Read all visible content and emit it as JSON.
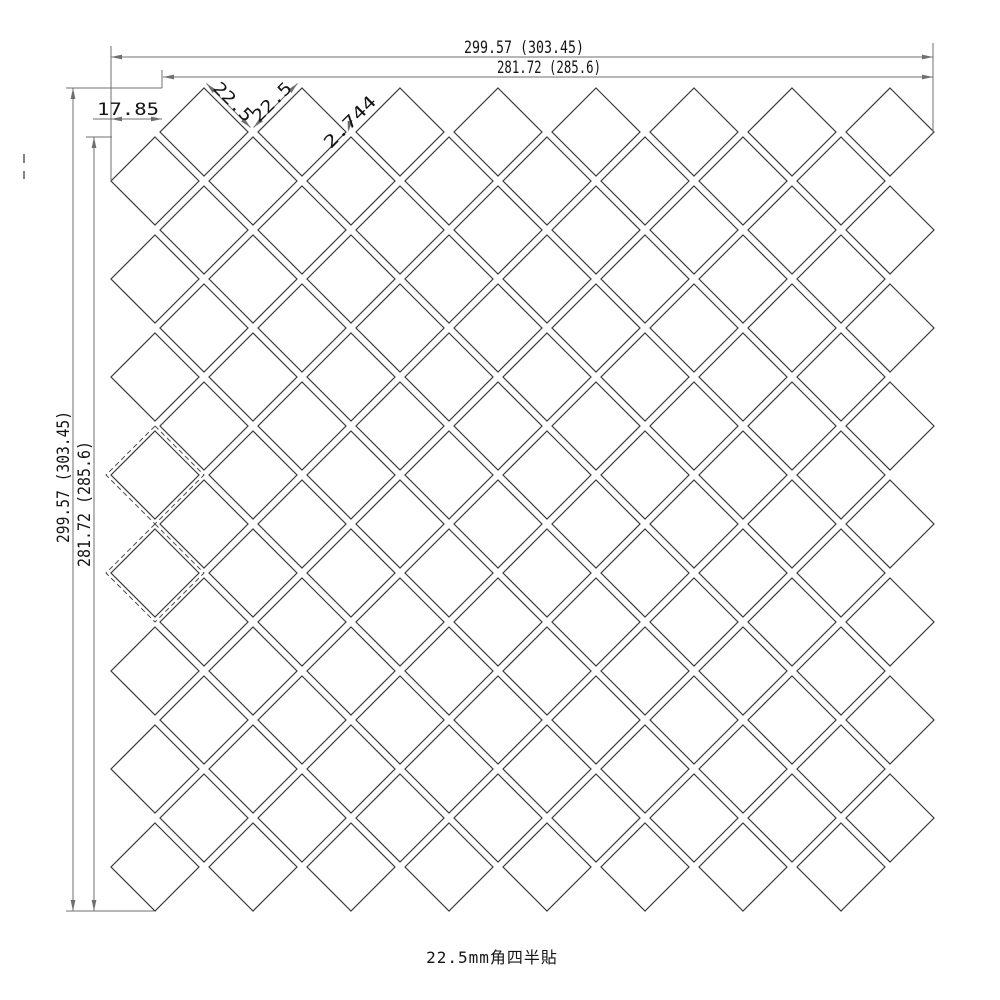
{
  "drawing": {
    "caption": "22.5mm角四半貼",
    "colors": {
      "background": "#ffffff",
      "tile_line": "#3a3a3a",
      "dash_line": "#4a4a4a",
      "dim_line": "#6f6f6f",
      "dim_text": "#141414"
    },
    "pattern": {
      "tile_size_mm": "22.5",
      "joint_mm": "2.744",
      "tile_half_diag_px": 44,
      "dash_half_diag_px": 49,
      "pitch_px": 98,
      "grid_a": {
        "x0": 204,
        "y0": 132,
        "cols": 8,
        "rows": 8
      },
      "grid_b": {
        "x0": 155,
        "y0": 181,
        "cols": 8,
        "rows": 8
      },
      "dashed_cells": [
        {
          "cx": 155,
          "cy": 475,
          "r": 49
        },
        {
          "cx": 155,
          "cy": 573,
          "r": 49
        }
      ]
    },
    "extension_lines": [
      [
        111,
        46,
        111,
        181
      ],
      [
        933,
        43,
        933,
        132
      ],
      [
        162,
        70,
        162,
        88
      ],
      [
        66,
        88,
        162,
        88
      ],
      [
        86,
        137,
        112,
        137
      ],
      [
        66,
        911,
        154,
        911
      ]
    ],
    "stray_marks": [
      [
        24,
        154,
        24,
        163
      ],
      [
        24,
        171,
        24,
        179
      ]
    ],
    "dims": [
      {
        "name": "dim-top-outer",
        "label": "299.57 (303.45)",
        "line": [
          111,
          57,
          933,
          57
        ],
        "arrows": [
          [
            111,
            57,
            180
          ],
          [
            933,
            57,
            0
          ]
        ],
        "label_pos": [
          524,
          53
        ],
        "rot": 0,
        "tlen": 120
      },
      {
        "name": "dim-top-inner",
        "label": "281.72 (285.6)",
        "line": [
          163,
          77,
          933,
          77
        ],
        "arrows": [
          [
            163,
            77,
            180
          ],
          [
            933,
            77,
            0
          ]
        ],
        "label_pos": [
          549,
          73
        ],
        "rot": 0,
        "tlen": 104
      },
      {
        "name": "dim-left-outer",
        "label": "299.57 (303.45)",
        "line": [
          73,
          88,
          73,
          911
        ],
        "arrows": [
          [
            73,
            88,
            270
          ],
          [
            73,
            911,
            90
          ]
        ],
        "label_pos": [
          69,
          477
        ],
        "rot": -90,
        "tlen": 132
      },
      {
        "name": "dim-left-inner",
        "label": "281.72 (285.6)",
        "line": [
          94,
          137,
          94,
          911
        ],
        "arrows": [
          [
            94,
            137,
            270
          ],
          [
            94,
            911,
            90
          ]
        ],
        "label_pos": [
          90,
          504
        ],
        "rot": -90,
        "tlen": 126
      },
      {
        "name": "dim-left-offset",
        "label": "17.85",
        "line": [
          93,
          119,
          162,
          119
        ],
        "arrows": [
          [
            111,
            119,
            180
          ],
          [
            162,
            119,
            0
          ]
        ],
        "label_pos": [
          128,
          115
        ],
        "rot": 0,
        "tlen": 62
      },
      {
        "name": "dim-tile-edge-1",
        "label": "22.5",
        "line": [
          206.5,
          83.5,
          250.5,
          127.5
        ],
        "arrows": [
          [
            206.5,
            83.5,
            225
          ],
          [
            250.5,
            127.5,
            45
          ]
        ],
        "label_pos": [
          229,
          106
        ],
        "rot": 45,
        "tlen": 48
      },
      {
        "name": "dim-tile-edge-2",
        "label": "22.5",
        "line": [
          253.5,
          127.5,
          297.5,
          83.5
        ],
        "arrows": [
          [
            253.5,
            127.5,
            135
          ],
          [
            297.5,
            83.5,
            315
          ]
        ],
        "label_pos": [
          276,
          106
        ],
        "rot": -45,
        "tlen": 48
      },
      {
        "name": "dim-joint",
        "label": "2.744",
        "line": [
          352,
          120,
          348.5,
          130
        ],
        "arrows": [
          [
            348,
            132,
            100
          ]
        ],
        "label_pos": [
          354,
          126
        ],
        "rot": -45,
        "tlen": 66
      }
    ]
  }
}
